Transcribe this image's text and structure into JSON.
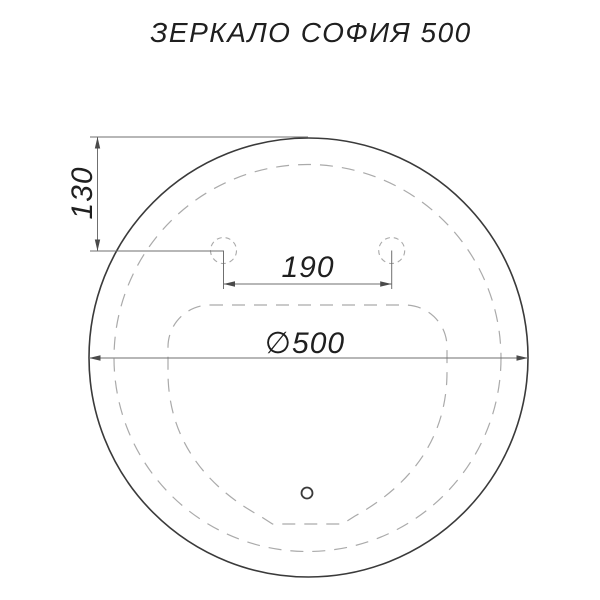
{
  "title": "ЗЕРКАЛО СОФИЯ 500",
  "dimensions": {
    "top_offset": "130",
    "hole_spacing": "190",
    "diameter": "∅500"
  },
  "colors": {
    "solid_line": "#3a3a3a",
    "dashed_line": "#aaaaaa",
    "dimension_line": "#6f6f6f",
    "arrow_fill": "#4a4a4a",
    "text": "#1f1f1f",
    "background": "#ffffff"
  }
}
